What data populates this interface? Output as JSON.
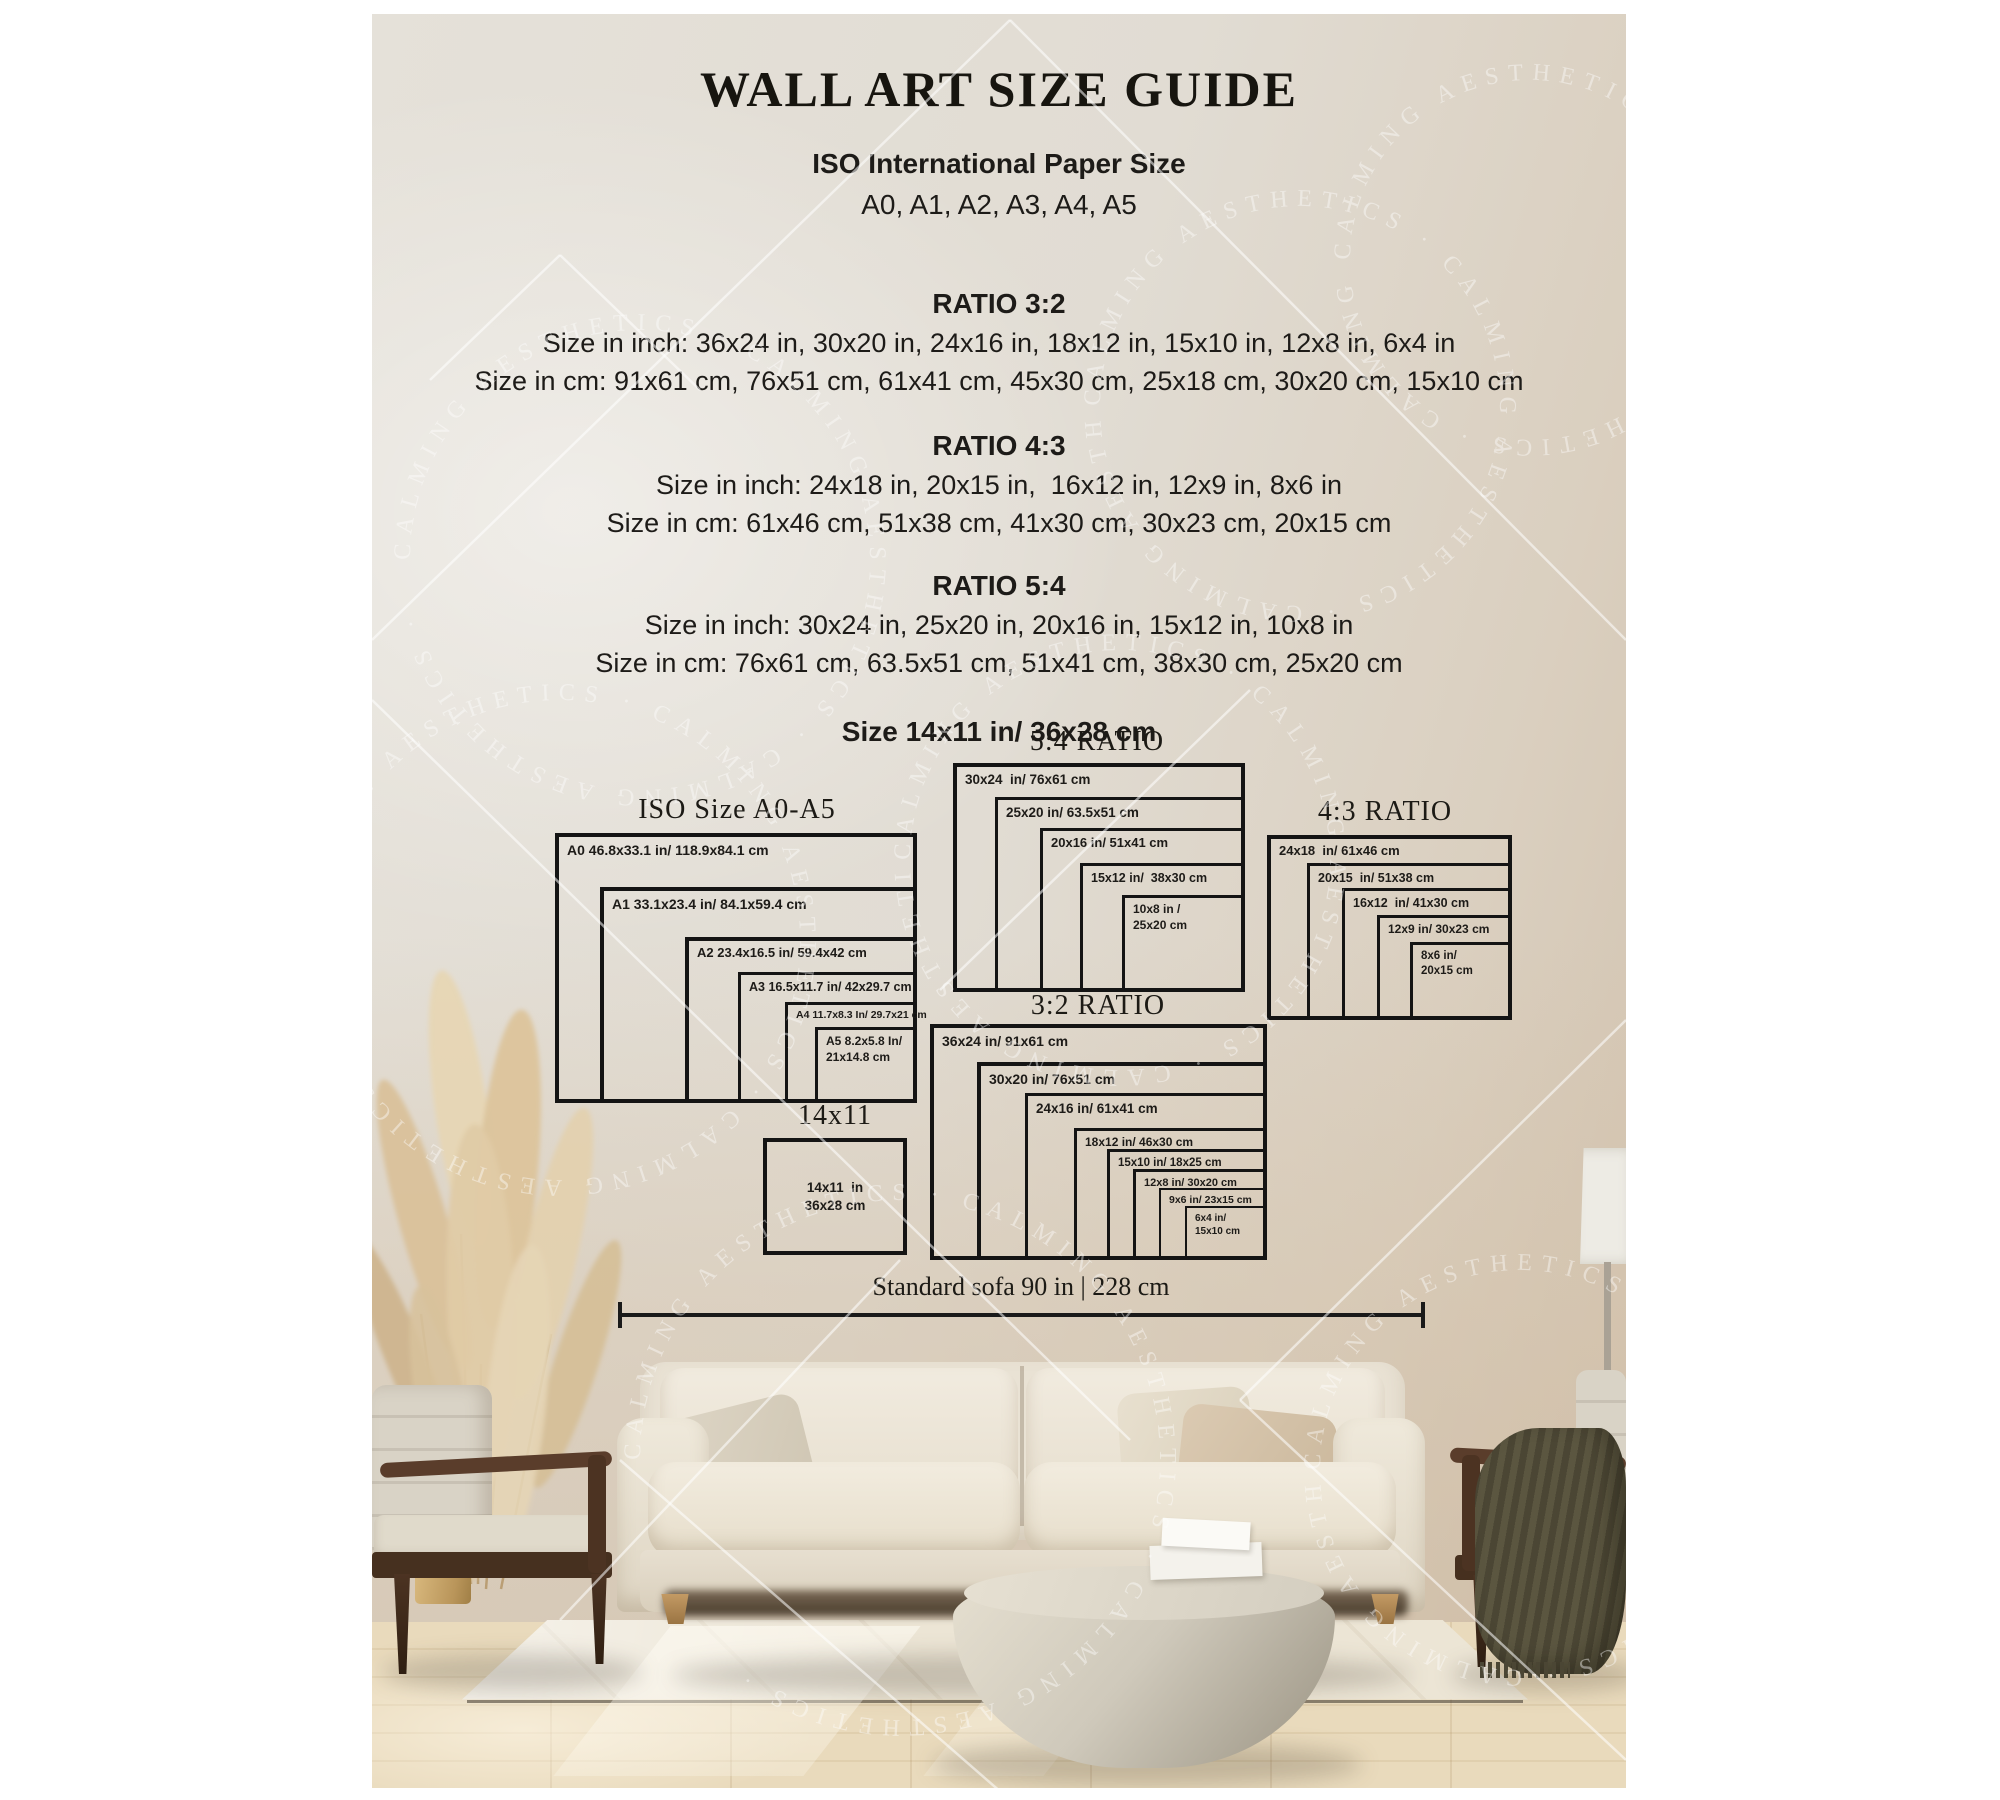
{
  "poster": {
    "title": "WALL ART SIZE GUIDE",
    "iso_header": {
      "line1": "ISO International Paper Size",
      "line2": "A0, A1, A2, A3, A4, A5"
    },
    "ratio_sections": [
      {
        "name": "RATIO 3:2",
        "inch": "Size in inch: 36x24 in, 30x20 in, 24x16 in, 18x12 in, 15x10 in, 12x8 in, 6x4 in",
        "cm": "Size in cm: 91x61 cm, 76x51 cm, 61x41 cm, 45x30 cm, 25x18 cm, 30x20 cm, 15x10 cm"
      },
      {
        "name": "RATIO 4:3",
        "inch": "Size in inch: 24x18 in, 20x15 in,  16x12 in, 12x9 in, 8x6 in",
        "cm": "Size in cm: 61x46 cm, 51x38 cm, 41x30 cm, 30x23 cm, 20x15 cm"
      },
      {
        "name": "RATIO 5:4",
        "inch": "Size in inch: 30x24 in, 25x20 in, 20x16 in, 15x12 in, 10x8 in",
        "cm": "Size in cm: 76x61 cm, 63.5x51 cm, 51x41 cm, 38x30 cm, 25x20 cm"
      }
    ],
    "size_note": "Size 14x11 in/ 36x28 cm",
    "sofa_measure": "Standard sofa 90 in | 228 cm",
    "watermark_text": "CALMING AESTHETICS",
    "watermark_repeat": "CALMING AESTHETICS · CALMING AESTHETICS · CALMING AESTHETICS ·"
  },
  "diagrams": [
    {
      "id": "ratio-5-4",
      "heading": "5:4 RATIO",
      "heading_cx": 725,
      "heading_top": 712,
      "boxes": [
        {
          "label": "30x24  in/ 76x61 cm",
          "x": 581,
          "y": 749,
          "w": 292,
          "h": 229,
          "bw": 4,
          "fs": 13.5
        },
        {
          "label": "25x20 in/ 63.5x51 cm",
          "x": 623,
          "y": 783,
          "w": 250,
          "h": 195,
          "bw": 3.5,
          "fs": 13.5
        },
        {
          "label": "20x16 in/ 51x41 cm",
          "x": 668,
          "y": 814,
          "w": 205,
          "h": 164,
          "bw": 3.5,
          "fs": 13
        },
        {
          "label": "15x12 in/  38x30 cm",
          "x": 708,
          "y": 849,
          "w": 165,
          "h": 129,
          "bw": 3,
          "fs": 12.5
        },
        {
          "lines": [
            "10x8 in /",
            "25x20 cm"
          ],
          "x": 750,
          "y": 881,
          "w": 123,
          "h": 97,
          "bw": 3,
          "fs": 12
        }
      ]
    },
    {
      "id": "iso-a0-a5",
      "heading": "ISO Size A0-A5",
      "heading_cx": 365,
      "heading_top": 780,
      "boxes": [
        {
          "label": "A0 46.8x33.1 in/ 118.9x84.1 cm",
          "x": 183,
          "y": 819,
          "w": 362,
          "h": 270,
          "bw": 4.5,
          "fs": 14
        },
        {
          "label": "A1 33.1x23.4 in/ 84.1x59.4 cm",
          "x": 228,
          "y": 873,
          "w": 317,
          "h": 216,
          "bw": 4.5,
          "fs": 14
        },
        {
          "label": "A2 23.4x16.5 in/ 59.4x42 cm",
          "x": 313,
          "y": 923,
          "w": 232,
          "h": 166,
          "bw": 4,
          "fs": 13
        },
        {
          "label": "A3 16.5x11.7 in/ 42x29.7 cm",
          "x": 366,
          "y": 958,
          "w": 179,
          "h": 131,
          "bw": 3.5,
          "fs": 12.5
        },
        {
          "label": "A4 11.7x8.3 In/ 29.7x21 cm",
          "x": 413,
          "y": 988,
          "w": 132,
          "h": 101,
          "bw": 3,
          "fs": 10.5
        },
        {
          "lines": [
            "A5 8.2x5.8 In/",
            "21x14.8 cm"
          ],
          "x": 443,
          "y": 1013,
          "w": 102,
          "h": 76,
          "bw": 3,
          "fs": 12
        }
      ]
    },
    {
      "id": "ratio-4-3",
      "heading": "4:3 RATIO",
      "heading_cx": 1013,
      "heading_top": 782,
      "boxes": [
        {
          "label": "24x18  in/ 61x46 cm",
          "x": 895,
          "y": 821,
          "w": 245,
          "h": 185,
          "bw": 4,
          "fs": 13
        },
        {
          "label": "20x15  in/ 51x38 cm",
          "x": 935,
          "y": 849,
          "w": 205,
          "h": 157,
          "bw": 3.5,
          "fs": 12.5
        },
        {
          "label": "16x12  in/ 41x30 cm",
          "x": 970,
          "y": 874,
          "w": 170,
          "h": 132,
          "bw": 3.5,
          "fs": 12.5
        },
        {
          "label": "12x9 in/ 30x23 cm",
          "x": 1005,
          "y": 901,
          "w": 135,
          "h": 105,
          "bw": 3,
          "fs": 12
        },
        {
          "lines": [
            "8x6 in/",
            "20x15 cm"
          ],
          "x": 1038,
          "y": 928,
          "w": 102,
          "h": 78,
          "bw": 3,
          "fs": 11.5
        }
      ]
    },
    {
      "id": "ratio-3-2",
      "heading": "3:2 RATIO",
      "heading_cx": 726,
      "heading_top": 976,
      "boxes": [
        {
          "label": "36x24 in/ 91x61 cm",
          "x": 558,
          "y": 1010,
          "w": 337,
          "h": 236,
          "bw": 4,
          "fs": 14
        },
        {
          "label": "30x20 in/ 76x51 cm",
          "x": 605,
          "y": 1048,
          "w": 290,
          "h": 198,
          "bw": 4,
          "fs": 14
        },
        {
          "label": "24x16 in/ 61x41 cm",
          "x": 653,
          "y": 1079,
          "w": 242,
          "h": 167,
          "bw": 3.5,
          "fs": 13.5
        },
        {
          "label": "18x12 in/ 46x30 cm",
          "x": 702,
          "y": 1114,
          "w": 193,
          "h": 132,
          "bw": 3,
          "fs": 12
        },
        {
          "label": "15x10 in/ 18x25 cm",
          "x": 735,
          "y": 1135,
          "w": 160,
          "h": 111,
          "bw": 3,
          "fs": 11.5
        },
        {
          "label": "12x8 in/ 30x20 cm",
          "x": 761,
          "y": 1155,
          "w": 134,
          "h": 91,
          "bw": 3,
          "fs": 11
        },
        {
          "label": "9x6 in/ 23x15 cm",
          "x": 787,
          "y": 1174,
          "w": 108,
          "h": 72,
          "bw": 2.5,
          "fs": 10.5
        },
        {
          "lines": [
            "6x4 in/",
            "15x10 cm"
          ],
          "x": 813,
          "y": 1192,
          "w": 82,
          "h": 54,
          "bw": 2.5,
          "fs": 10
        }
      ]
    },
    {
      "id": "size-14x11",
      "heading": "14x11",
      "heading_cx": 463,
      "heading_top": 1086,
      "boxes": [
        {
          "lines": [
            "14x11  in",
            "36x28 cm"
          ],
          "x": 391,
          "y": 1124,
          "w": 144,
          "h": 117,
          "bw": 4,
          "fs": 13.5,
          "center": true
        }
      ]
    }
  ],
  "colors": {
    "page_background": "#ffffff",
    "poster_wall": "#e1dcd3",
    "text": "#1d1b18",
    "box_border": "#141414",
    "wood_floor": "#e5d4b4",
    "rug": "#ece5d5",
    "sofa": "#ece5d7",
    "chair_wood": "#54392a",
    "blanket_olive": "#55503c",
    "stone_table": "#c9c3b5",
    "pampas": "#dcc49f",
    "watermark_white": "#ffffff"
  }
}
